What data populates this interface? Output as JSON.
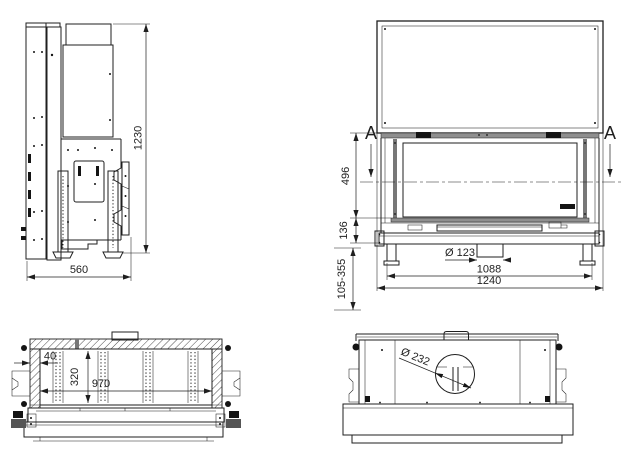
{
  "drawing": {
    "kind": "technical-drawing",
    "colors": {
      "line": "#1f1f1f",
      "metal_bar": "#8f8f8f",
      "background": "#ffffff"
    },
    "side_view": {
      "height": "1230",
      "depth": "560"
    },
    "front_view": {
      "section_marker_left": "A",
      "section_marker_right": "A",
      "glass_height": "496",
      "base_height": "136",
      "leg_height_range": "105-355",
      "air_inlet_diameter": "Ø 123",
      "leg_span": "1088",
      "overall_width": "1240"
    },
    "section_view": {
      "wall_thickness": "40",
      "firebox_height": "320",
      "firebox_width": "970"
    },
    "top_view": {
      "flue_diameter": "Ø 232"
    }
  }
}
